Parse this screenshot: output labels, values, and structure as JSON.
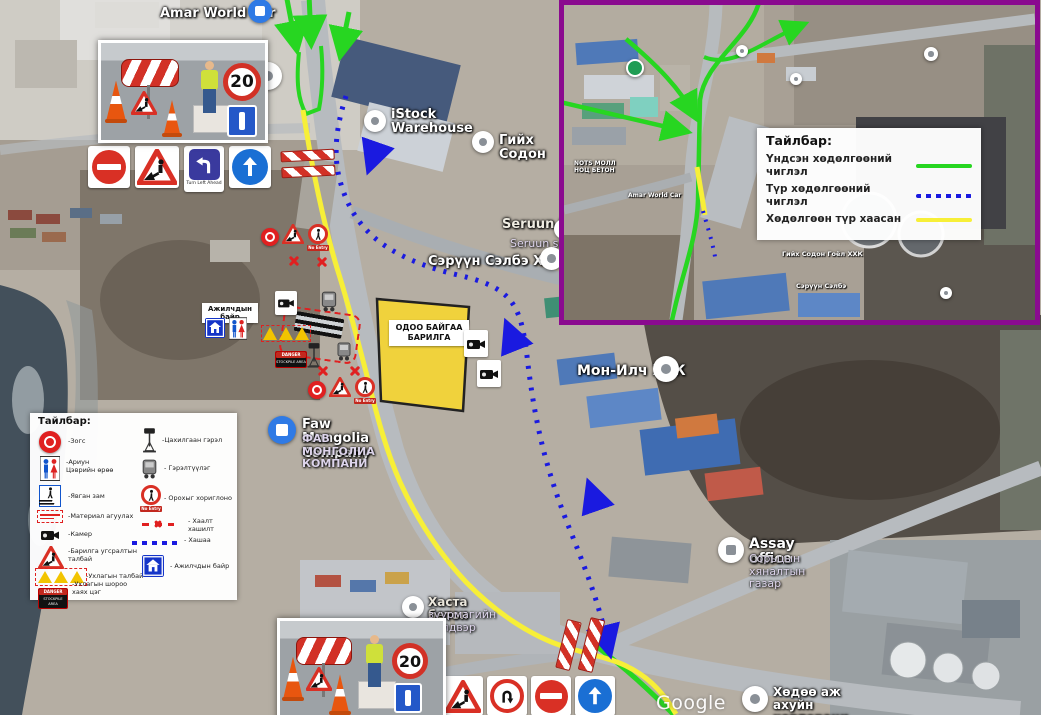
{
  "colors": {
    "route-green": "#27d621",
    "route-blue": "#1a1ae0",
    "route-yellow": "#f7ef38",
    "inset-border": "#8a0a8f",
    "sign-red": "#d93025",
    "sign-blue": "#1a6fd4"
  },
  "map": {
    "watermark": "Google"
  },
  "inset_legend": {
    "title": "Тайлбар:",
    "items": [
      {
        "label": "Үндсэн хөдөлгөөний чиглэл",
        "style": "green-solid"
      },
      {
        "label": "Түр хөдөлгөөний чиглэл",
        "style": "blue-dotted"
      },
      {
        "label": "Хөдөлгөөн түр хаасан",
        "style": "yellow-solid"
      }
    ]
  },
  "map_legend": {
    "title": "Тайлбар:",
    "left_items": [
      {
        "icon": "stop-paddle-icon",
        "label": "-Зогс"
      },
      {
        "icon": "restroom-icon",
        "label": "-Ариун\nЦэврийн өрөө"
      },
      {
        "icon": "crosswalk-icon",
        "label": "-Явган зам"
      },
      {
        "icon": "material-storage-icon",
        "label": "-Материал агуулах"
      },
      {
        "icon": "camera-icon",
        "label": "-Камер"
      },
      {
        "icon": "roadworks-icon",
        "label": "-Барилга угсралтын\nталбай"
      },
      {
        "icon": "excavation-triangles-icon",
        "label": "-Ухлагын талбай"
      },
      {
        "icon": "stockpile-icon",
        "label": "-Ухлагын шороо\nхаях цэг"
      }
    ],
    "right_items": [
      {
        "icon": "light-tower-icon",
        "label": "-Цахилгаан гэрэл"
      },
      {
        "icon": "generator-icon",
        "label": "- Гэрэлтүүлэг"
      },
      {
        "icon": "no-pedestrian-icon",
        "label": "- Орохыг хориглоно"
      },
      {
        "icon": "barrier-line-icon",
        "label": "- Хаалт хашилт"
      },
      {
        "icon": "fence-line-icon",
        "label": "- Хашаа"
      },
      {
        "icon": "workers-quarters-icon",
        "label": "- Ажилчдын байр"
      }
    ]
  },
  "pois": {
    "amar": {
      "name": "Amar World Car"
    },
    "istock": {
      "name": "iStock\nWarehouse"
    },
    "giikh": {
      "name": "Гийх Содон"
    },
    "seruun_en": {
      "name": "Seruun Selbe",
      "sub": "Seruun selbe"
    },
    "seruun_mn": {
      "name": "Сэрүүн Сэлбэ ХХК"
    },
    "monilch": {
      "name": "Мон-Илч ХХК"
    },
    "faw": {
      "name": "Faw Mongolia Company",
      "sub": "ФАВ МОНГОЛИА\nКОМПАНИ"
    },
    "assay": {
      "name": "Assay office",
      "sub": "Сорьцын\nхяналтын газар"
    },
    "hasta": {
      "name": "Хаста бетон",
      "sub": "зуурмагийн үйлдвэр"
    },
    "agro": {
      "name": "Хөдөө аж ахуйн\nкорпораци ТӨХХК"
    }
  },
  "inset_pois": {
    "nots": {
      "name": "NOTS МОЛЛ\nНОЦ БЕТОН"
    },
    "amar": {
      "name": "Amar World Car"
    },
    "giikh": {
      "name": "Гийх Содон Гоёл ХХК"
    },
    "seruun": {
      "name": "Сэрүүн Сэлбэ"
    }
  },
  "annotations": {
    "existing_building": "ОДОО БАЙГАА\nБАРИЛГА",
    "workers_quarters": "Ажилчдын байр",
    "speed_limit": "20",
    "turn_left_caption": "Turn Left Ahead",
    "no_entry_caption": "No Entry",
    "stockpile_danger": "DANGER",
    "stockpile_area": "STOCKPILE AREA"
  }
}
